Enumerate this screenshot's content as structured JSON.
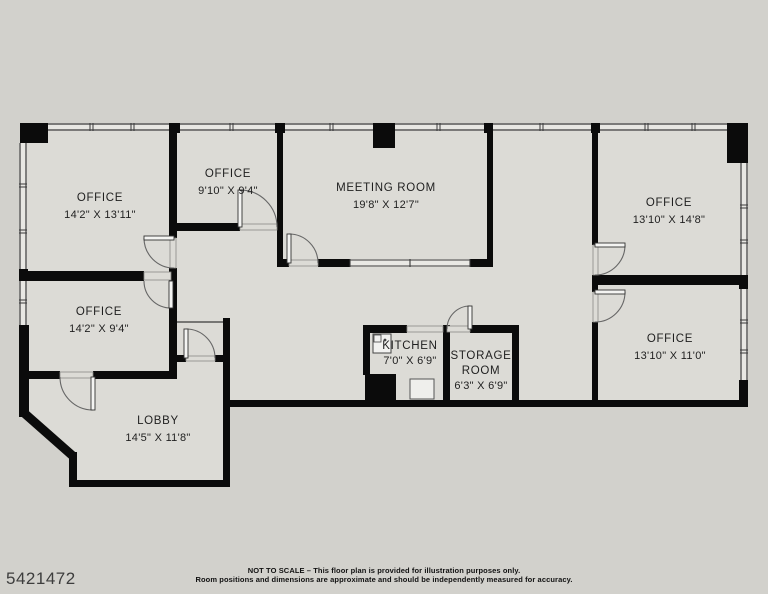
{
  "plan_number": "5421472",
  "rooms": [
    {
      "name": "OFFICE",
      "dims": "14'2\" X 13'11\""
    },
    {
      "name": "OFFICE",
      "dims": "9'10\" X 9'4\""
    },
    {
      "name": "MEETING ROOM",
      "dims": "19'8\" X 12'7\""
    },
    {
      "name": "OFFICE",
      "dims": "13'10\" X 14'8\""
    },
    {
      "name": "OFFICE",
      "dims": "14'2\" X 9'4\""
    },
    {
      "name": "KITCHEN",
      "dims": "7'0\" X 6'9\""
    },
    {
      "name": "STORAGE ROOM",
      "dims": "6'3\" X 6'9\""
    },
    {
      "name": "OFFICE",
      "dims": "13'10\" X 11'0\""
    },
    {
      "name": "LOBBY",
      "dims": "14'5\" X 11'8\""
    }
  ],
  "footer": {
    "line1": "NOT TO SCALE – This floor plan is provided for illustration purposes only.",
    "line2": "Room positions and dimensions are approximate and should be independently measured for accuracy."
  },
  "colors": {
    "background": "#d2d1cc",
    "floor": "#dcdbd6",
    "wall": "#0b0b0b",
    "window_band": "#e8e7e3",
    "text": "#1f1f1f"
  }
}
